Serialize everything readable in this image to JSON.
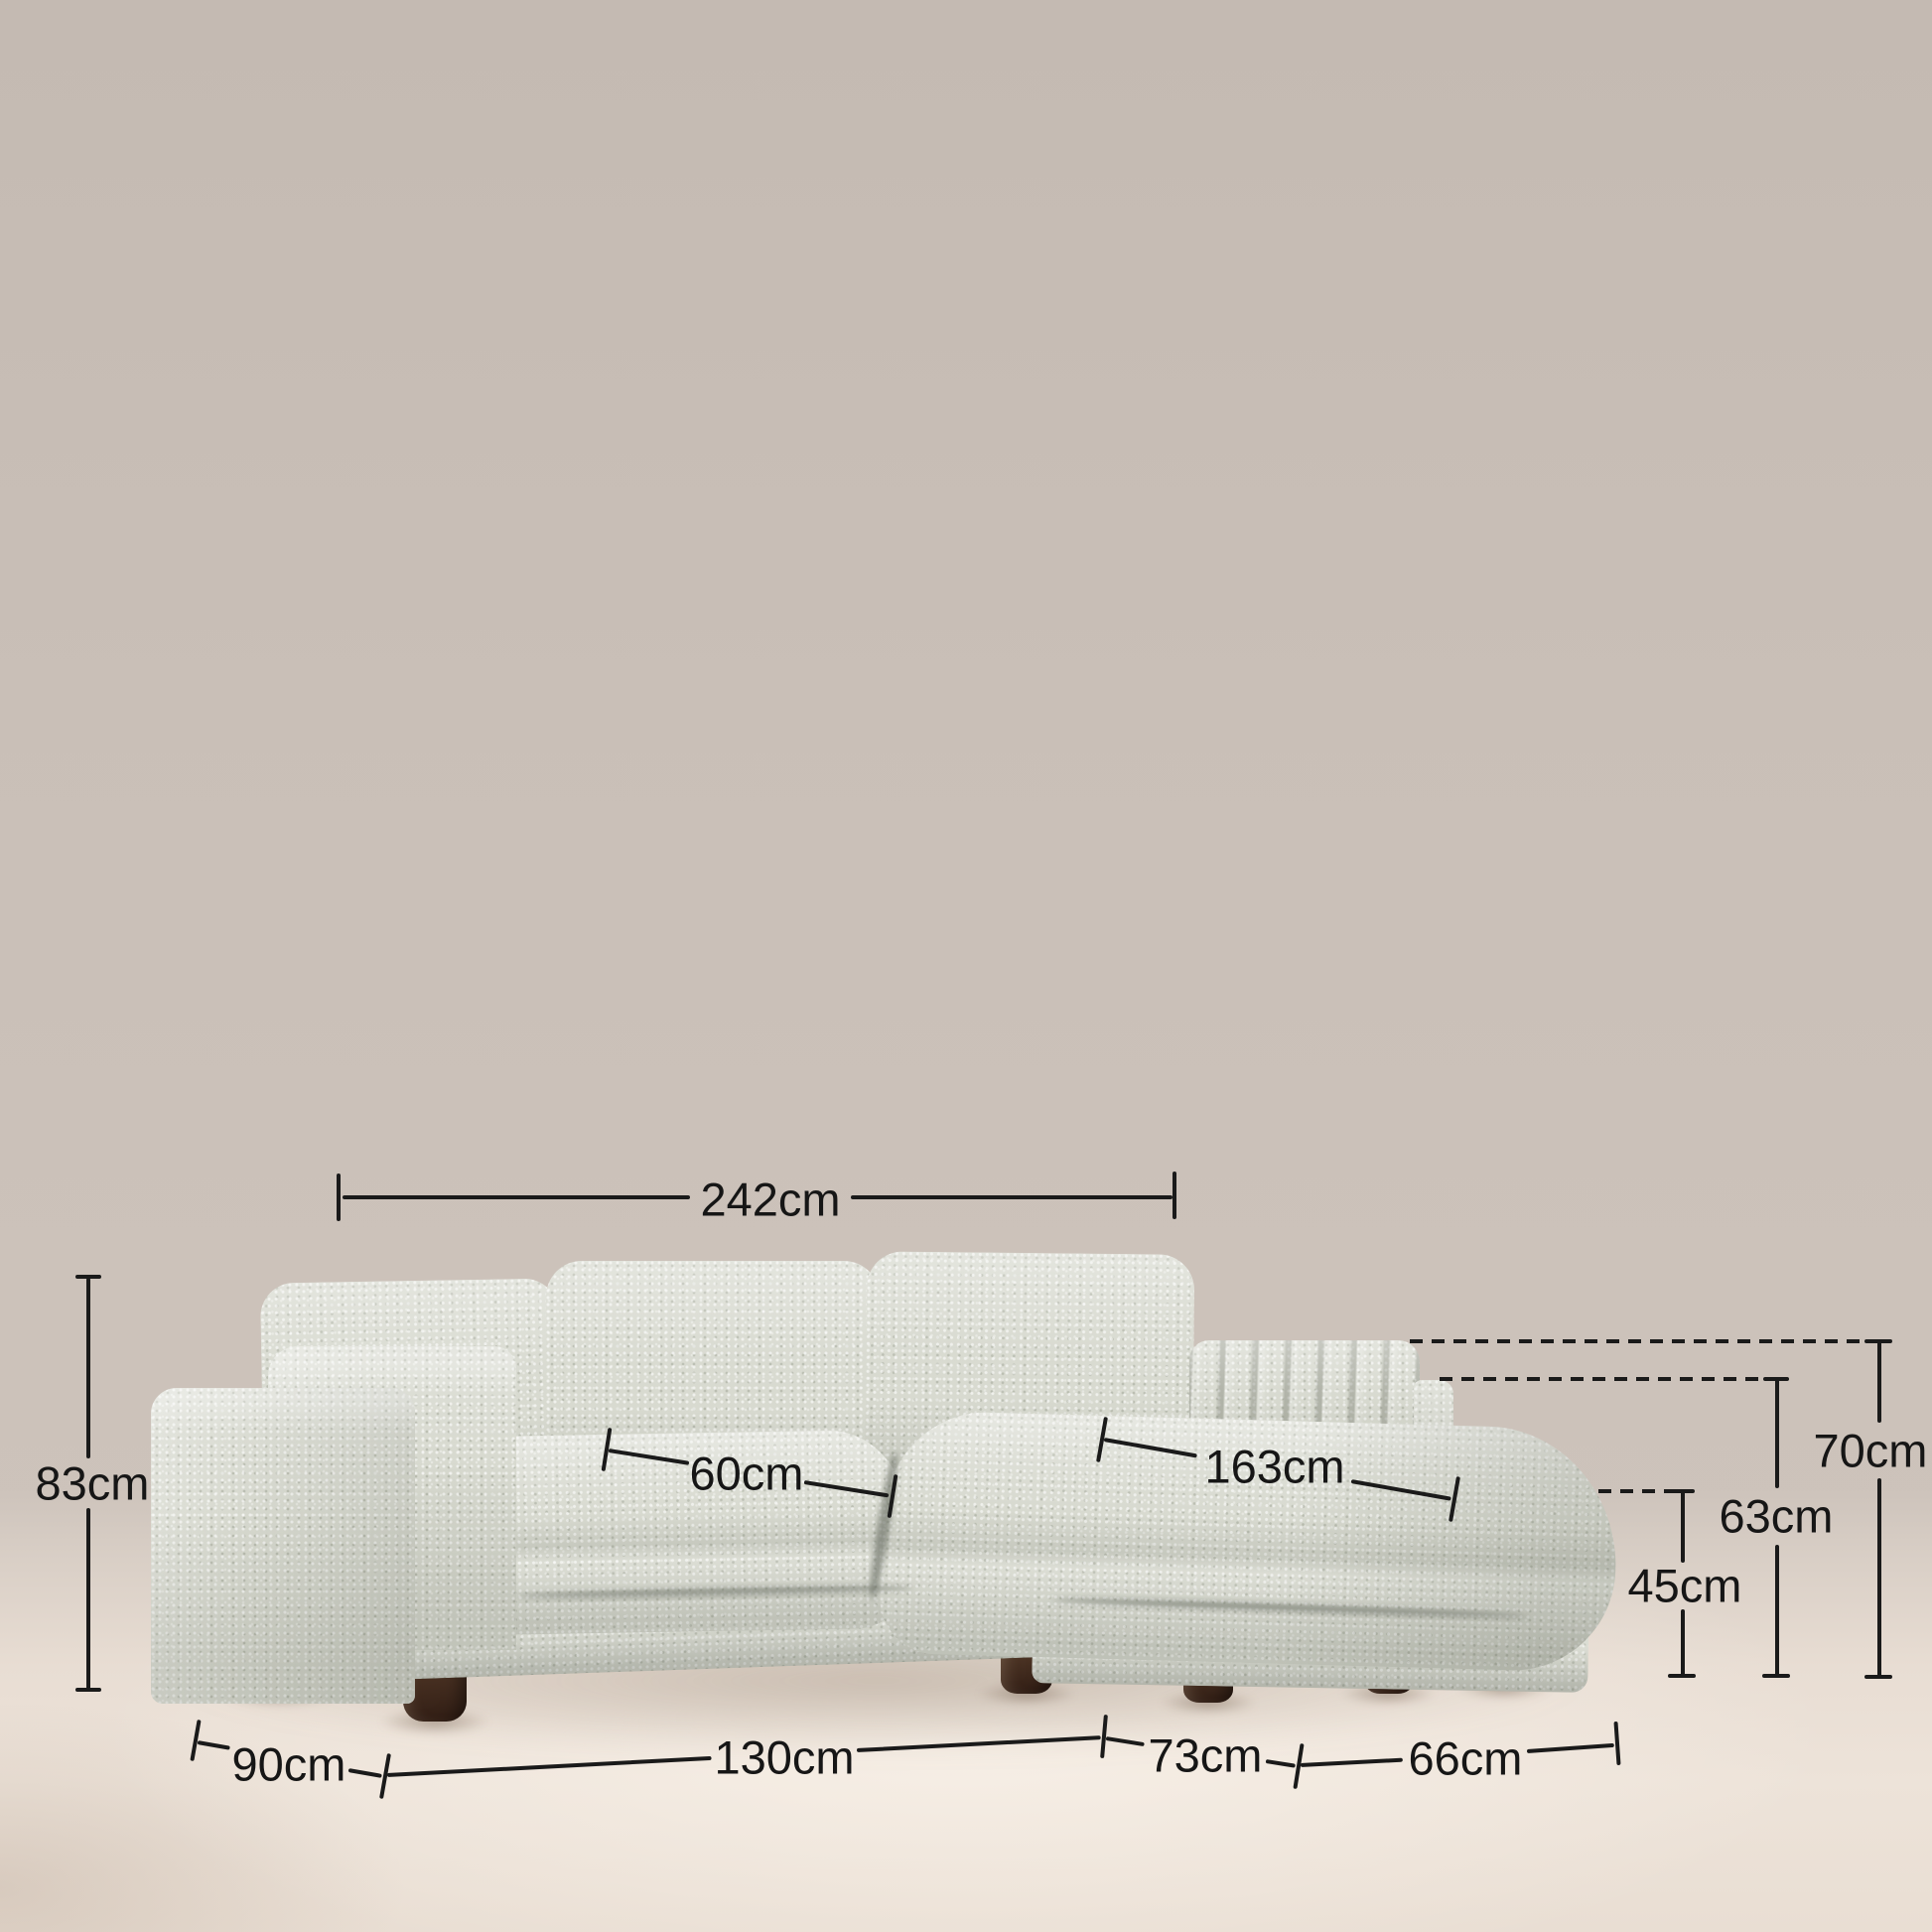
{
  "scene": "sofa-dimension-diagram",
  "colors": {
    "wall": "#cac0b8",
    "floor": "#ede3d9",
    "fabric": "#d8dad0",
    "legs": "#4a3223",
    "annotation": "#1a1a1a"
  },
  "labels": {
    "overall_width": "242cm",
    "overall_height": "83cm",
    "seat_depth": "60cm",
    "chaise_length": "163cm",
    "arm_height": "70cm",
    "side_height": "63cm",
    "seat_height": "45cm",
    "side_depth": "90cm",
    "front_width": "130cm",
    "mid_width": "73cm",
    "chaise_width": "66cm"
  }
}
